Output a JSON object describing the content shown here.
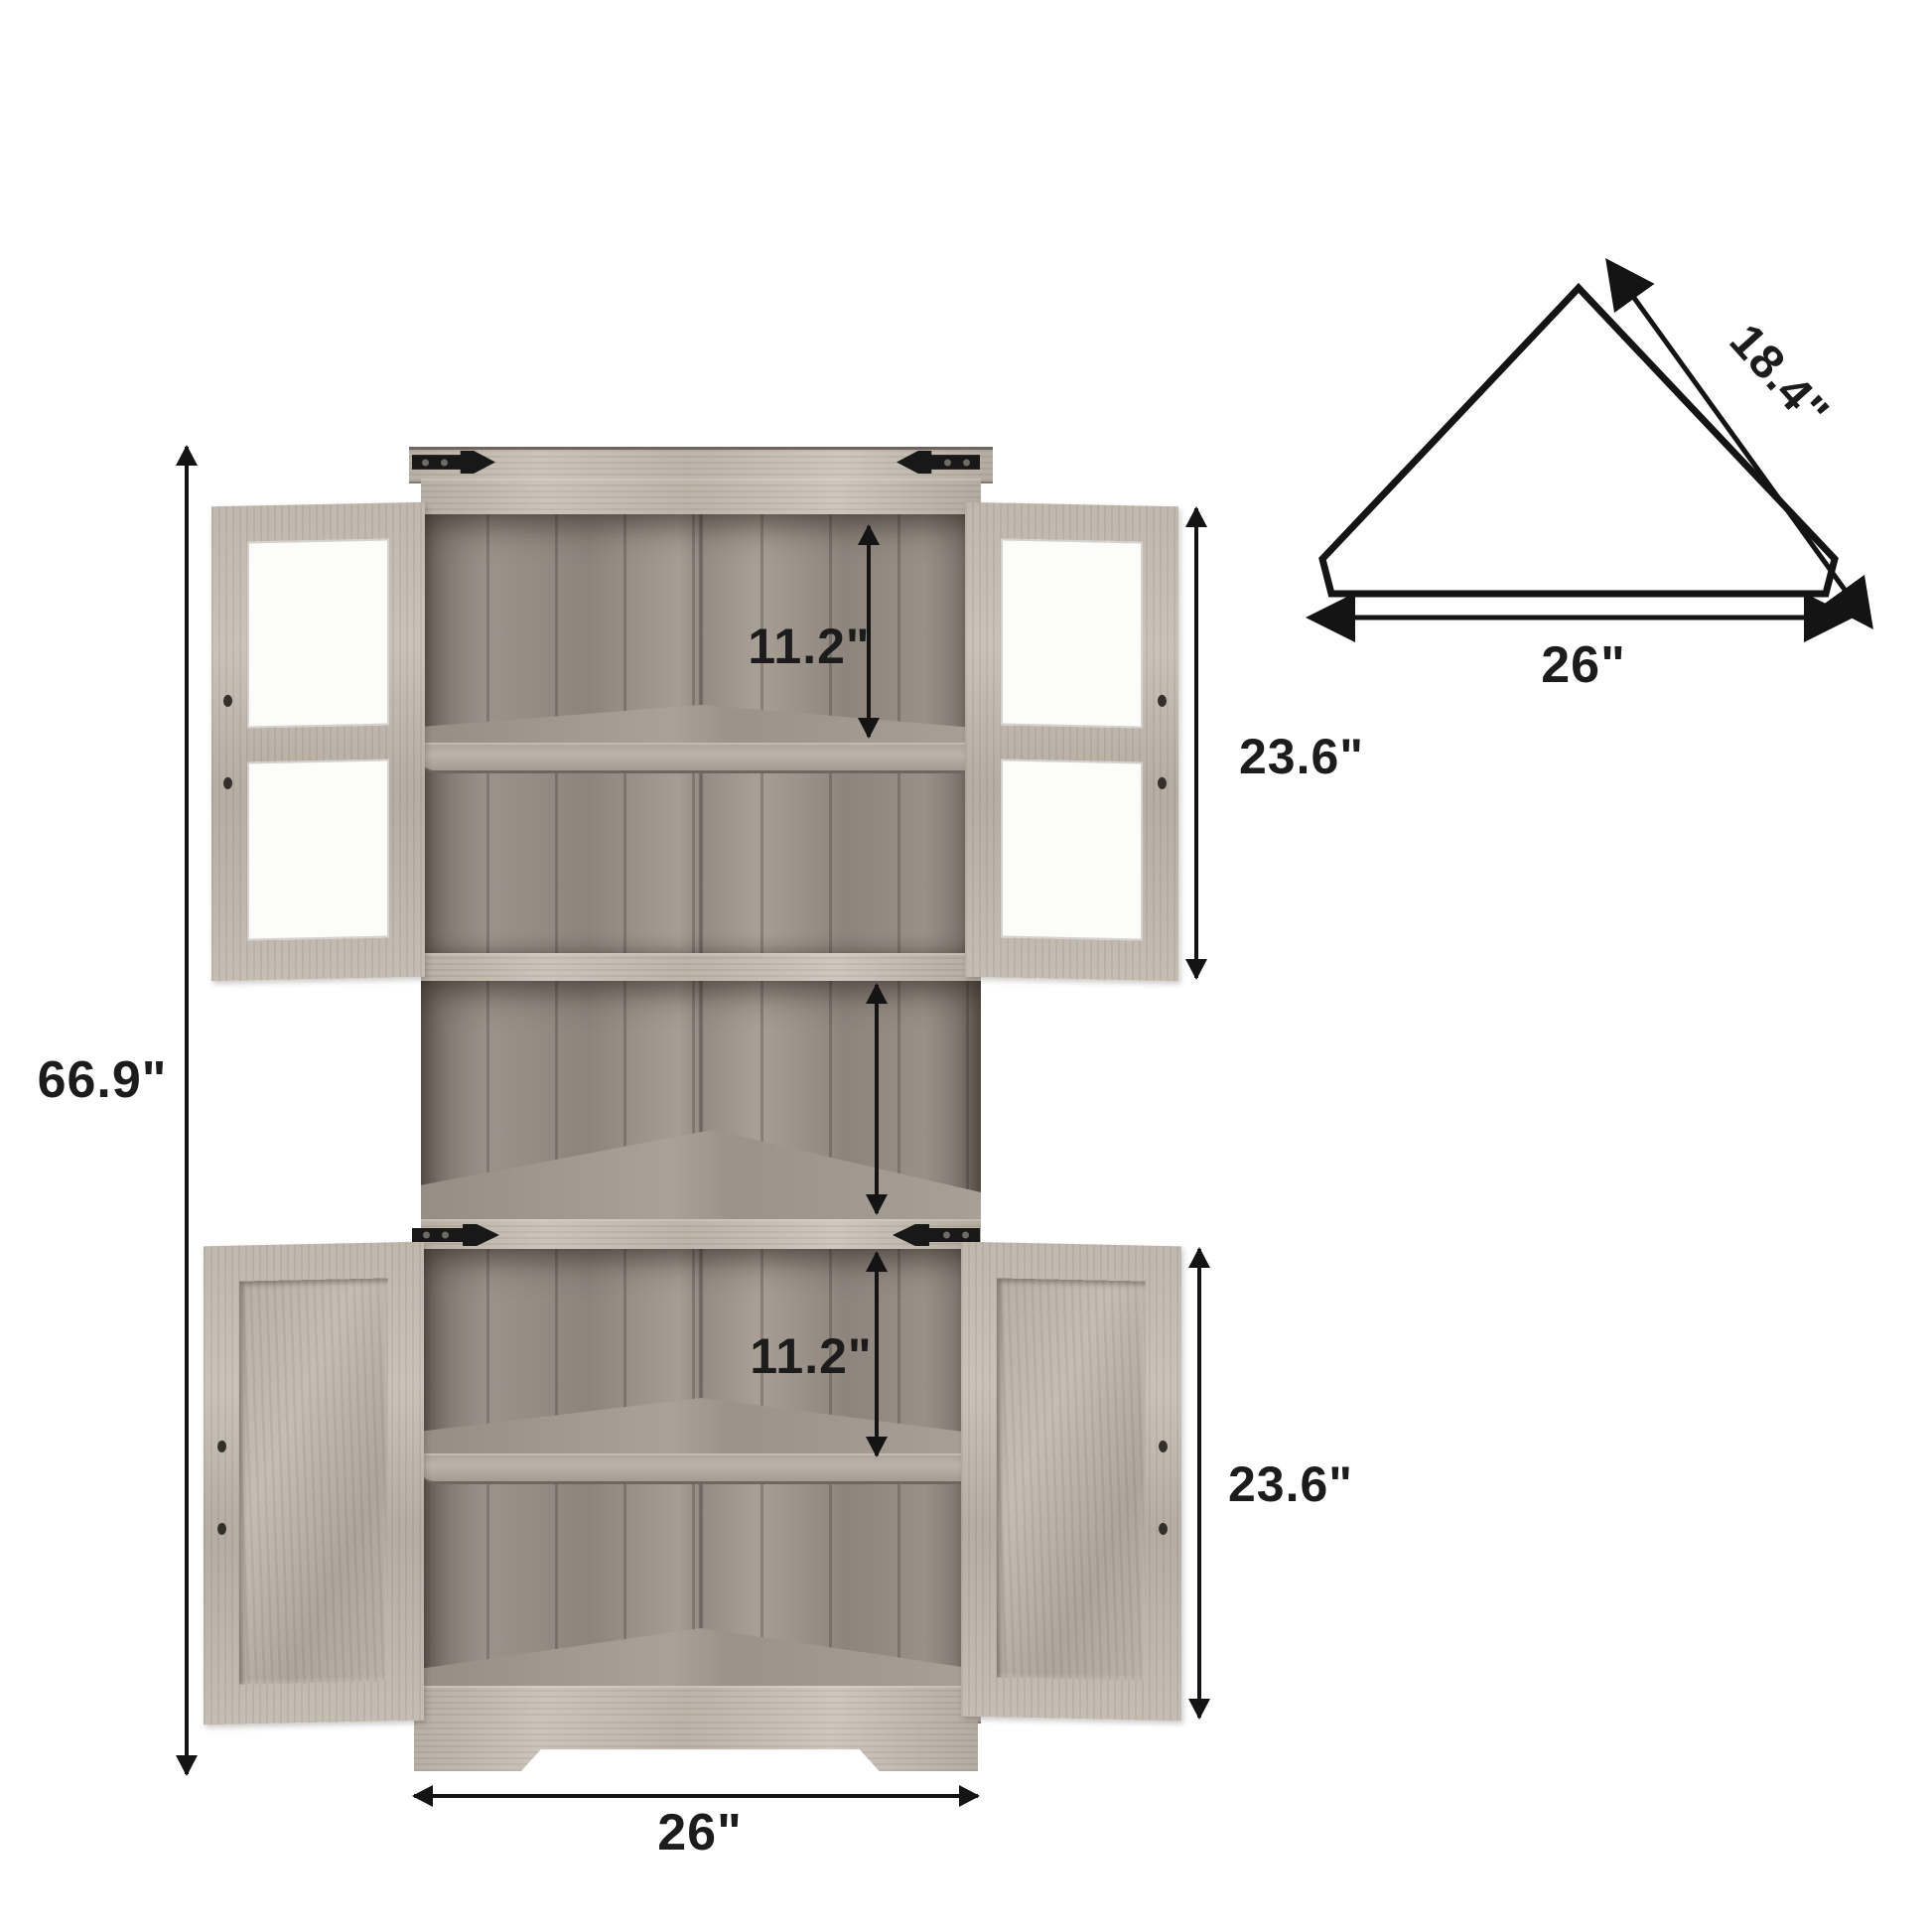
{
  "front_view": {
    "overall_height_label": "66.9\"",
    "upper": {
      "gap_label": "11.2\"",
      "door_label": "23.6\""
    },
    "lower": {
      "gap_label": "11.2\"",
      "door_label": "23.6\""
    },
    "base_width_label": "26\""
  },
  "top_view": {
    "depth_label": "18.4\"",
    "width_label": "26\""
  },
  "colors": {
    "line": "#141414",
    "wood_light": "#c6beb3",
    "wood_mid": "#a39a90",
    "wood_dark": "#7d756c",
    "glass": "#fcfcfb",
    "hinge": "#181818",
    "background": "#ffffff"
  }
}
